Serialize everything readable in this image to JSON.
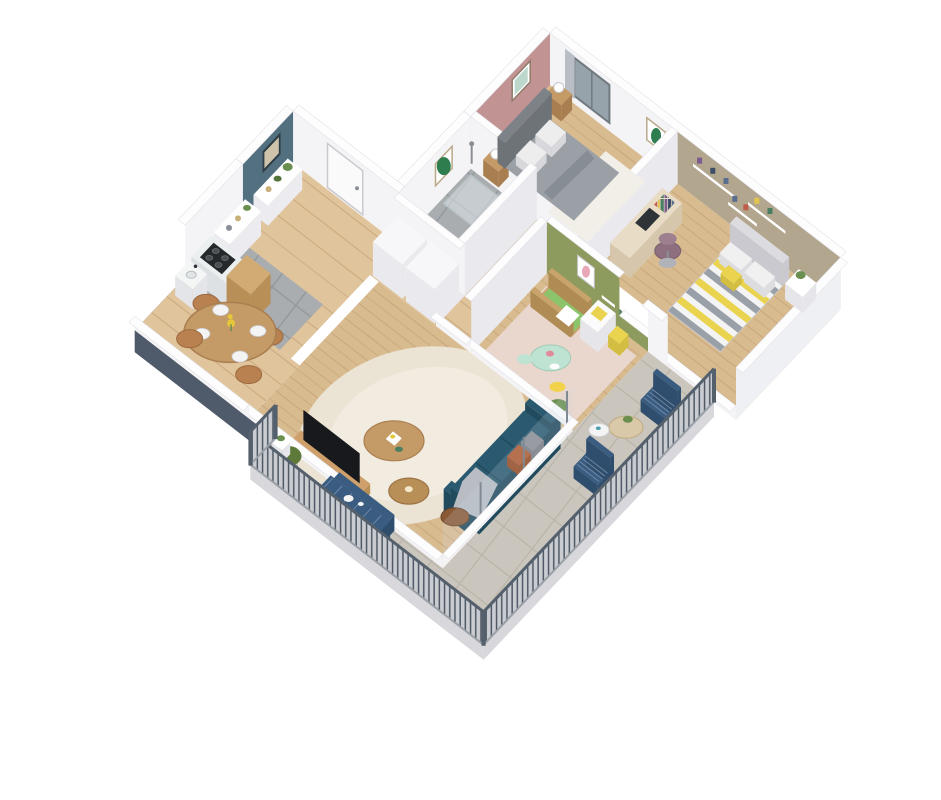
{
  "canvas": {
    "width": 941,
    "height": 800,
    "background": "#ffffff"
  },
  "scene_type": "3d-isometric-apartment-floor-plan",
  "colors": {
    "wallWhite": "#f4f4f6",
    "wallShade": "#e9e9ee",
    "wallOuter": "#eef0f3",
    "wallTop": "#fdfdfe",
    "wallTopStroke": "#e2e2e8",
    "slabDark": "#4f5a6b",
    "slabLight": "#d8d8dc",
    "accentTeal": "#52707f",
    "accentPink": "#c29393",
    "accentGreen": "#8d9c5e",
    "accentBeige": "#b3a68f",
    "woodFloor": "#d9bb90",
    "woodFloorLine": "#c9a87c",
    "woodFloor2": "#e0c49c",
    "tileGray": "#a9adb0",
    "tileGrout": "#93989c",
    "balconyTile": "#cac6bd",
    "balconyGrout": "#b8b4aa",
    "rugCream": "#ebe3d4",
    "rugCreamInner": "#f2ece0",
    "rugNursery": "#e9d6cc",
    "rugWhite": "#f2efe9",
    "bathRug": "#e9e5e0",
    "sofaTeal": "#2b5a70",
    "sofaTealDark": "#224a5d",
    "pillowRust": "#b0582f",
    "pillowGray": "#8d8d93",
    "throwGray": "#b9bcc2",
    "bedGray": "#9aa0a6",
    "bedGrayDark": "#878d94",
    "headboardGray": "#7d8288",
    "chevYellow": "#e9d34f",
    "chevGray": "#9aa0a8",
    "chevWhite": "#f4f4f4",
    "chairPurple": "#8d6f80",
    "cribWood": "#c8a36b",
    "cribGreen": "#8bc46a",
    "outdoorBlue": "#3a5c80",
    "outdoorBlueDark": "#2f4d6c",
    "railingPost": "#4f5a66",
    "railingBase": "#c9ccd1",
    "railingTop": "#55606d",
    "woodTable": "#c49a66",
    "woodTableDark": "#a97f52",
    "sideTableBrown": "#8a5a36",
    "dresserWhite": "#fbfbfb",
    "marble": "#eceff0",
    "marbleSide": "#dde1e3",
    "cooktopBlack": "#26292c",
    "tvBlack": "#17191c",
    "mediaWood": "#cfa06b",
    "plantGreen": "#6a8f4f",
    "plantGreenDark": "#55743c",
    "boxwoodGreen": "#5d7a3a",
    "doorWhite": "#fafafb",
    "glassBlue": "#97a3ab",
    "glassTint": "#cfe0e8",
    "curtainGray": "#b9bec4",
    "lampWhite": "#ffffff",
    "artBeige": "#cfc4ab",
    "artGreenLeaf": "#2e7d4f",
    "artColorful": "#bcd8cc",
    "artBunnyPink": "#e8a8b8",
    "rattanTan": "#d9c9a8",
    "mintTable": "#bfe3d2",
    "bookColors": [
      "#5a6f8f",
      "#c05c4a",
      "#e3c54e",
      "#4a7f62",
      "#7a5c8f",
      "#3d4f66"
    ]
  },
  "rooms": [
    {
      "name": "entrance-hall",
      "accent_wall_color_key": "accentTeal",
      "floor": "wood"
    },
    {
      "name": "kitchen",
      "accent_wall_color_key": null,
      "floor": "wood-and-gray-tile"
    },
    {
      "name": "dining-area",
      "accent_wall_color_key": null,
      "floor": "wood"
    },
    {
      "name": "living-room",
      "accent_wall_color_key": null,
      "floor": "wood"
    },
    {
      "name": "bathroom",
      "accent_wall_color_key": null,
      "floor": "gray-tile"
    },
    {
      "name": "master-bedroom",
      "accent_wall_color_key": "accentPink",
      "floor": "wood"
    },
    {
      "name": "kids-bedroom",
      "accent_wall_color_key": "accentBeige",
      "floor": "wood"
    },
    {
      "name": "nursery",
      "accent_wall_color_key": "accentGreen",
      "floor": "wood"
    },
    {
      "name": "balcony-terrace",
      "accent_wall_color_key": null,
      "floor": "beige-tile"
    }
  ],
  "furniture": {
    "entrance-hall": [
      "framed-abstract-art",
      "white-console-shelf",
      "potted-plants",
      "front-door"
    ],
    "kitchen": [
      "white-shelving-unit",
      "marble-counter",
      "black-cooktop",
      "wood-cabinet",
      "sink"
    ],
    "dining-area": [
      "round-wood-table",
      "four-plates",
      "yellow-flowers",
      "four-wood-chairs"
    ],
    "living-room": [
      "teal-sofa",
      "gray-pillow",
      "rust-pillow",
      "gray-throw",
      "cream-rug",
      "two-round-coffee-tables",
      "dark-side-table",
      "tv",
      "media-board",
      "potted-plant"
    ],
    "bathroom": [
      "shower",
      "vanity-sink",
      "washing-machine",
      "round-rug",
      "green-leaf-art"
    ],
    "master-bedroom": [
      "double-bed-gray",
      "headboard",
      "two-nightstands",
      "two-sphere-lamps",
      "window-with-curtain",
      "colorful-art",
      "cactus-art",
      "white-rug"
    ],
    "kids-bedroom": [
      "bed-chevron-yellow-gray",
      "desk",
      "laptop",
      "purple-office-chair",
      "low-bookshelf",
      "floating-shelves-with-toys",
      "nightstand-with-plant"
    ],
    "nursery": [
      "wood-crib-green-mattress",
      "white-dresser",
      "yellow-boxes",
      "mint-kids-table",
      "two-stools",
      "pink-rug",
      "bunny-art"
    ],
    "balcony-terrace": [
      "blue-lounge-chairs",
      "rattan-round-table",
      "small-white-table",
      "blue-slat-dining-table",
      "blue-bench",
      "blue-chairs",
      "boxwood-ball-planter",
      "metal-railing"
    ]
  }
}
